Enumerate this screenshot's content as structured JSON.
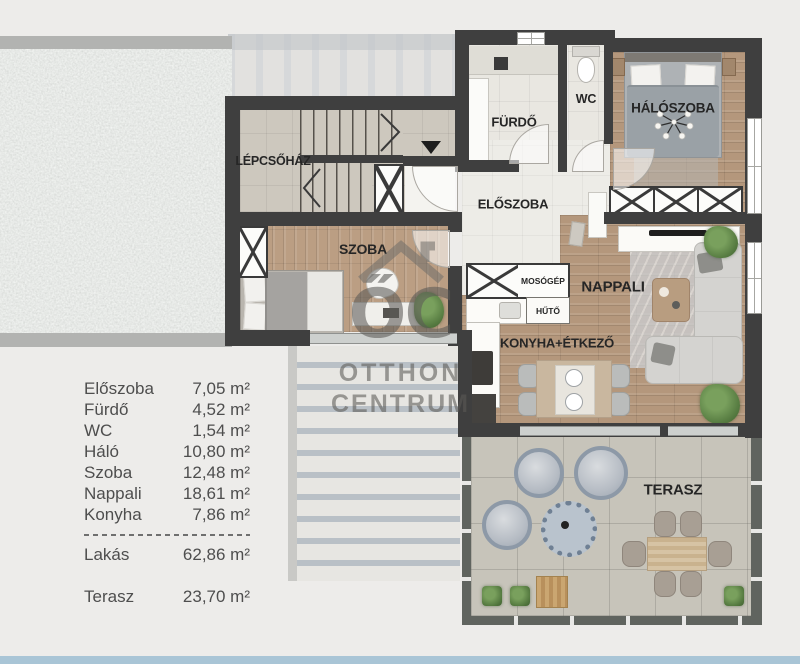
{
  "floorplan": {
    "rooms": {
      "lepcsohaz": "LÉPCSŐHÁZ",
      "furdo": "FÜRDŐ",
      "wc": "WC",
      "haloszoba": "HÁLÓSZOBA",
      "eloszoba": "ELŐSZOBA",
      "szoba": "SZOBA",
      "nappali": "NAPPALI",
      "konyha_etkezo": "KONYHA+ÉTKEZŐ",
      "terasz": "TERASZ"
    },
    "fixtures": {
      "mosogep": "MOSÓGÉP",
      "huto": "HŰTŐ"
    }
  },
  "legend": {
    "rows": [
      {
        "label": "Előszoba",
        "value": "7,05 m²"
      },
      {
        "label": "Fürdő",
        "value": "4,52 m²"
      },
      {
        "label": "WC",
        "value": "1,54 m²"
      },
      {
        "label": "Háló",
        "value": "10,80 m²"
      },
      {
        "label": "Szoba",
        "value": "12,48 m²"
      },
      {
        "label": "Nappali",
        "value": "18,61 m²"
      },
      {
        "label": "Konyha",
        "value": "7,86 m²"
      }
    ],
    "total": {
      "label": "Lakás",
      "value": "62,86 m²"
    },
    "terrace": {
      "label": "Terasz",
      "value": "23,70 m²"
    }
  },
  "watermark": {
    "logo": "ŐC",
    "line1": "OTTHON",
    "line2": "CENTRUM"
  },
  "colors": {
    "wall": "#3f3f3f",
    "wood_floor": "#b4977c",
    "tile_floor": "#cdc8be",
    "terrace_floor": "#c7c4ba",
    "gravel": "#d3d5d2",
    "background": "#edecea",
    "bottom_strip": "#a9c5d6",
    "watermark": "#8a8781"
  }
}
